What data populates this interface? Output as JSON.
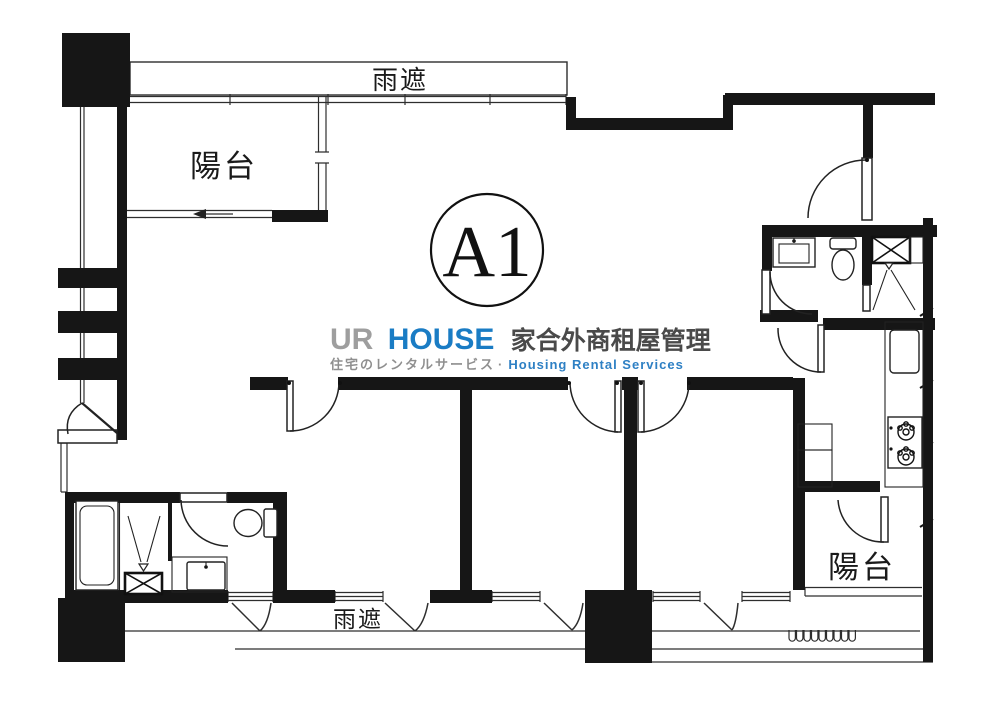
{
  "floor_plan": {
    "unit_label": "A1",
    "rain_shelter_top": "雨遮",
    "rain_shelter_bottom": "雨遮",
    "balcony_top_left": "陽台",
    "balcony_bottom_right": "陽台"
  },
  "watermark": {
    "brand_gray": "UR",
    "brand_blue": "HOUSE",
    "brand_cjk": "家合外商租屋管理",
    "tagline_jp": "住宅のレンタルサービス",
    "separator": "·",
    "tagline_en": "Housing Rental Services",
    "colors": {
      "brand_gray": "#9e9e9e",
      "brand_blue": "#1a7cc4",
      "brand_cjk": "#4a4a4a",
      "tagline_jp": "#8f8f8f",
      "tagline_en": "#2e80c4"
    }
  }
}
